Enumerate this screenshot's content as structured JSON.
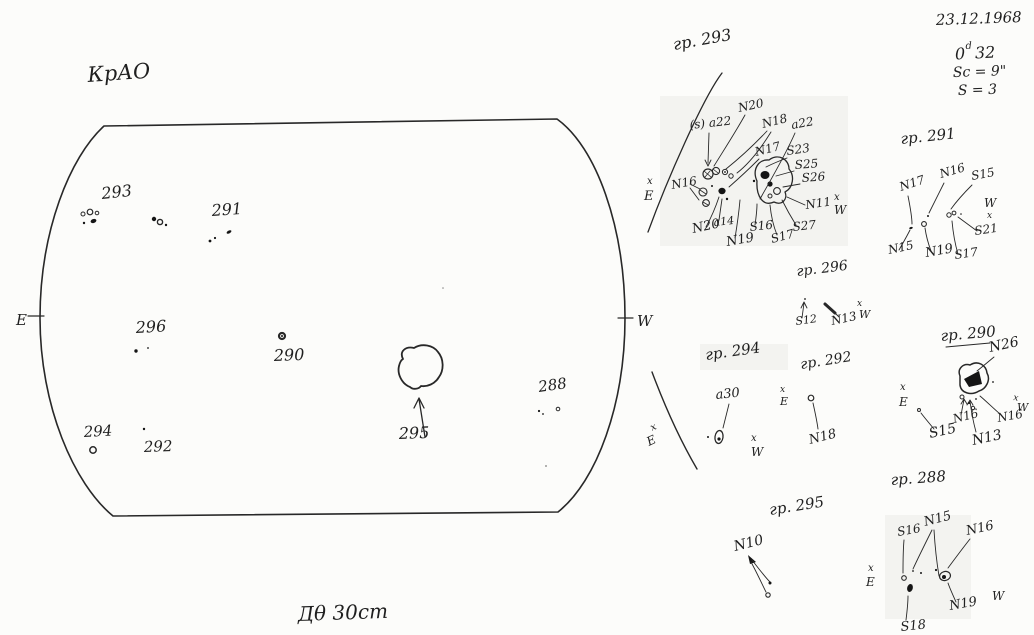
{
  "header": {
    "observatory": "КрАО",
    "date": "23.12.1968",
    "time_zero": "0",
    "time_sup": "d",
    "time_min": "32",
    "sc": "Sc = 9\"",
    "s": "S = 3"
  },
  "footer": {
    "caption": "Дθ  30cm"
  },
  "axis": {
    "x": "x",
    "e": "E",
    "w": "W"
  },
  "disk": {
    "east": "E",
    "west": "W",
    "groups": {
      "g293": "293",
      "g291": "291",
      "g296": "296",
      "g290": "290",
      "g294": "294",
      "g292": "292",
      "g295": "295",
      "g288": "288"
    }
  },
  "details": {
    "d293": {
      "title": "гр. 293",
      "labels": {
        "n20_top": "N20",
        "s_a22": "(s) a22",
        "n18": "N18",
        "a22": "a22",
        "n17": "N17",
        "s23": "S23",
        "s25": "S25",
        "s26": "S26",
        "n11": "N11",
        "n16": "N16",
        "n20_bottom": "N20",
        "a14": "a14",
        "n19": "N19",
        "s16": "S16",
        "s17": "S17",
        "s27": "S27"
      }
    },
    "d291": {
      "title": "гр. 291",
      "labels": {
        "n17": "N17",
        "n16": "N16",
        "s15": "S15",
        "s21": "S21",
        "n15": "N15",
        "n19": "N19",
        "s17": "S17"
      }
    },
    "d296": {
      "title": "гр. 296",
      "labels": {
        "s12": "S12",
        "n13": "N13"
      }
    },
    "d294": {
      "title": "гр. 294",
      "labels": {
        "a30": "a30"
      }
    },
    "d292": {
      "title": "гр. 292",
      "labels": {
        "n18": "N18"
      }
    },
    "d290": {
      "title": "гр. 290",
      "labels": {
        "n26": "N26",
        "s15": "S15",
        "n16_left": "N16",
        "n13": "N13",
        "n16_right": "N16"
      }
    },
    "d295": {
      "title": "гр. 295",
      "labels": {
        "n10": "N10"
      }
    },
    "d288": {
      "title": "гр. 288",
      "labels": {
        "s16": "S16",
        "n15": "N15",
        "n16": "N16",
        "n19": "N19",
        "s18": "S18"
      }
    }
  }
}
